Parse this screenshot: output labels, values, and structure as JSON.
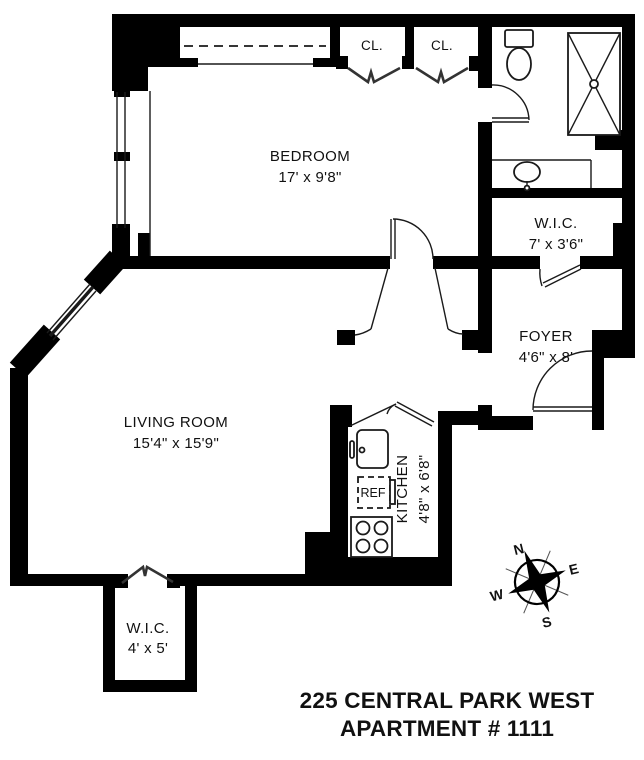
{
  "plan": {
    "rooms": {
      "bedroom": {
        "name": "BEDROOM",
        "dims": "17' x 9'8\""
      },
      "living_room": {
        "name": "LIVING ROOM",
        "dims": "15'4\" x 15'9\""
      },
      "kitchen": {
        "name": "KITCHEN",
        "dims": "4'8\" x 6'8\""
      },
      "wic_upper": {
        "name": "W.I.C.",
        "dims": "7' x 3'6\""
      },
      "foyer": {
        "name": "FOYER",
        "dims": "4'6\" x 8'"
      },
      "wic_lower": {
        "name": "W.I.C.",
        "dims": "4' x 5'"
      },
      "closet_left": {
        "name": "CL."
      },
      "closet_right": {
        "name": "CL."
      }
    },
    "fixtures": {
      "refrigerator_label": "REF"
    },
    "compass": {
      "north": "N",
      "east": "E",
      "south": "S",
      "west": "W"
    }
  },
  "footer": {
    "address_line1": "225 CENTRAL PARK WEST",
    "address_line2": "APARTMENT # 1111"
  },
  "colors": {
    "wall": "#000000",
    "line": "#1a1a1a",
    "text": "#111111"
  }
}
